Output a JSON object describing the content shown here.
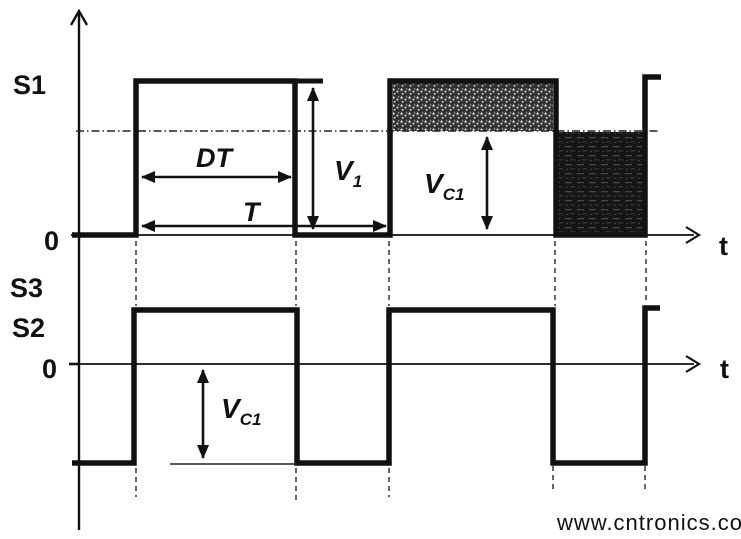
{
  "figure": {
    "kind": "switching-converter timing diagram",
    "background": "#ffffff",
    "ink_color": "#111111"
  },
  "top_chart": {
    "signal_label": "S1",
    "zero_label": "0",
    "time_axis_label": "t",
    "annotations": {
      "duty_interval": "DT",
      "period": "T",
      "v1": {
        "base": "V",
        "sub": "1"
      },
      "vc1": {
        "base": "V",
        "sub": "C1"
      }
    }
  },
  "bottom_chart": {
    "signal_label_upper": "S3",
    "signal_label_lower": "S2",
    "zero_label": "0",
    "time_axis_label": "t",
    "annotations": {
      "vc1": {
        "base": "V",
        "sub": "C1"
      }
    }
  },
  "waveforms": {
    "type": "timing",
    "period": "T",
    "on_time": "DT",
    "signals": [
      {
        "name": "S1",
        "levels": [
          "0",
          "V1"
        ],
        "description": "square pulses 0 to V1; level VC1 marked by gridline; shaded area above VC1 during on-time, dark area below VC1 during off-time"
      },
      {
        "name": "S2/S3",
        "levels": [
          "-VC1",
          "high"
        ],
        "description": "square wave in phase with S1, offset so off-level sits VC1 below zero"
      }
    ]
  },
  "watermark": {
    "text": "www.cntronics.com",
    "color": "#c9e7b8"
  }
}
